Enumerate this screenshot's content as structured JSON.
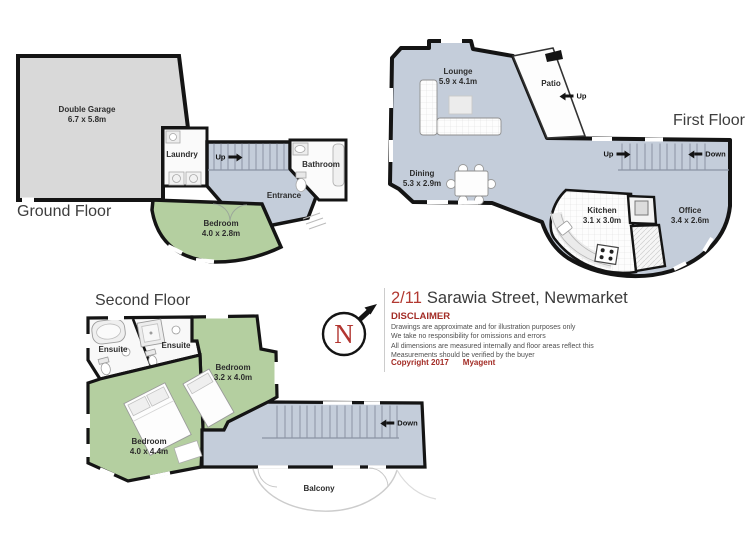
{
  "floors": {
    "ground": {
      "title": "Ground Floor",
      "garage_name": "Double Garage",
      "garage_dims": "6.7 x 5.8m",
      "laundry": "Laundry",
      "bathroom": "Bathroom",
      "entrance": "Entrance",
      "bedroom_name": "Bedroom",
      "bedroom_dims": "4.0 x 2.8m",
      "stairs_up": "Up"
    },
    "first": {
      "title": "First Floor",
      "lounge_name": "Lounge",
      "lounge_dims": "5.9 x 4.1m",
      "dining_name": "Dining",
      "dining_dims": "5.3 x 2.9m",
      "kitchen_name": "Kitchen",
      "kitchen_dims": "3.1 x 3.0m",
      "office_name": "Office",
      "office_dims": "3.4 x 2.6m",
      "patio": "Patio",
      "patio_up": "Up",
      "stairs_up": "Up",
      "stairs_down": "Down"
    },
    "second": {
      "title": "Second Floor",
      "ensuite1": "Ensuite",
      "ensuite2": "Ensuite",
      "bedroom1_name": "Bedroom",
      "bedroom1_dims": "3.2 x 4.0m",
      "bedroom2_name": "Bedroom",
      "bedroom2_dims": "4.0 x 4.4m",
      "stairs_down": "Down",
      "balcony": "Balcony"
    }
  },
  "info": {
    "address_unit": "2/11",
    "address_street": "Sarawia Street, Newmarket",
    "disclaimer_title": "DISCLAIMER",
    "line1": "Drawings are approximate and for illustration purposes only",
    "line2": "We take no responsibility for omissions and errors",
    "line3": "All dimensions are measured internally and floor areas reflect this",
    "line4": "Measurements should be verified by the buyer",
    "copyright": "Copyright 2017",
    "agency": "Myagent",
    "compass_n": "N"
  },
  "colors": {
    "floor_blue": "#c4cdda",
    "room_green": "#b4cfa0",
    "garage_grey": "#d9d9d9",
    "wall_black": "#141414",
    "accent_red": "#b23931",
    "disclaimer_red": "#a32c26"
  }
}
